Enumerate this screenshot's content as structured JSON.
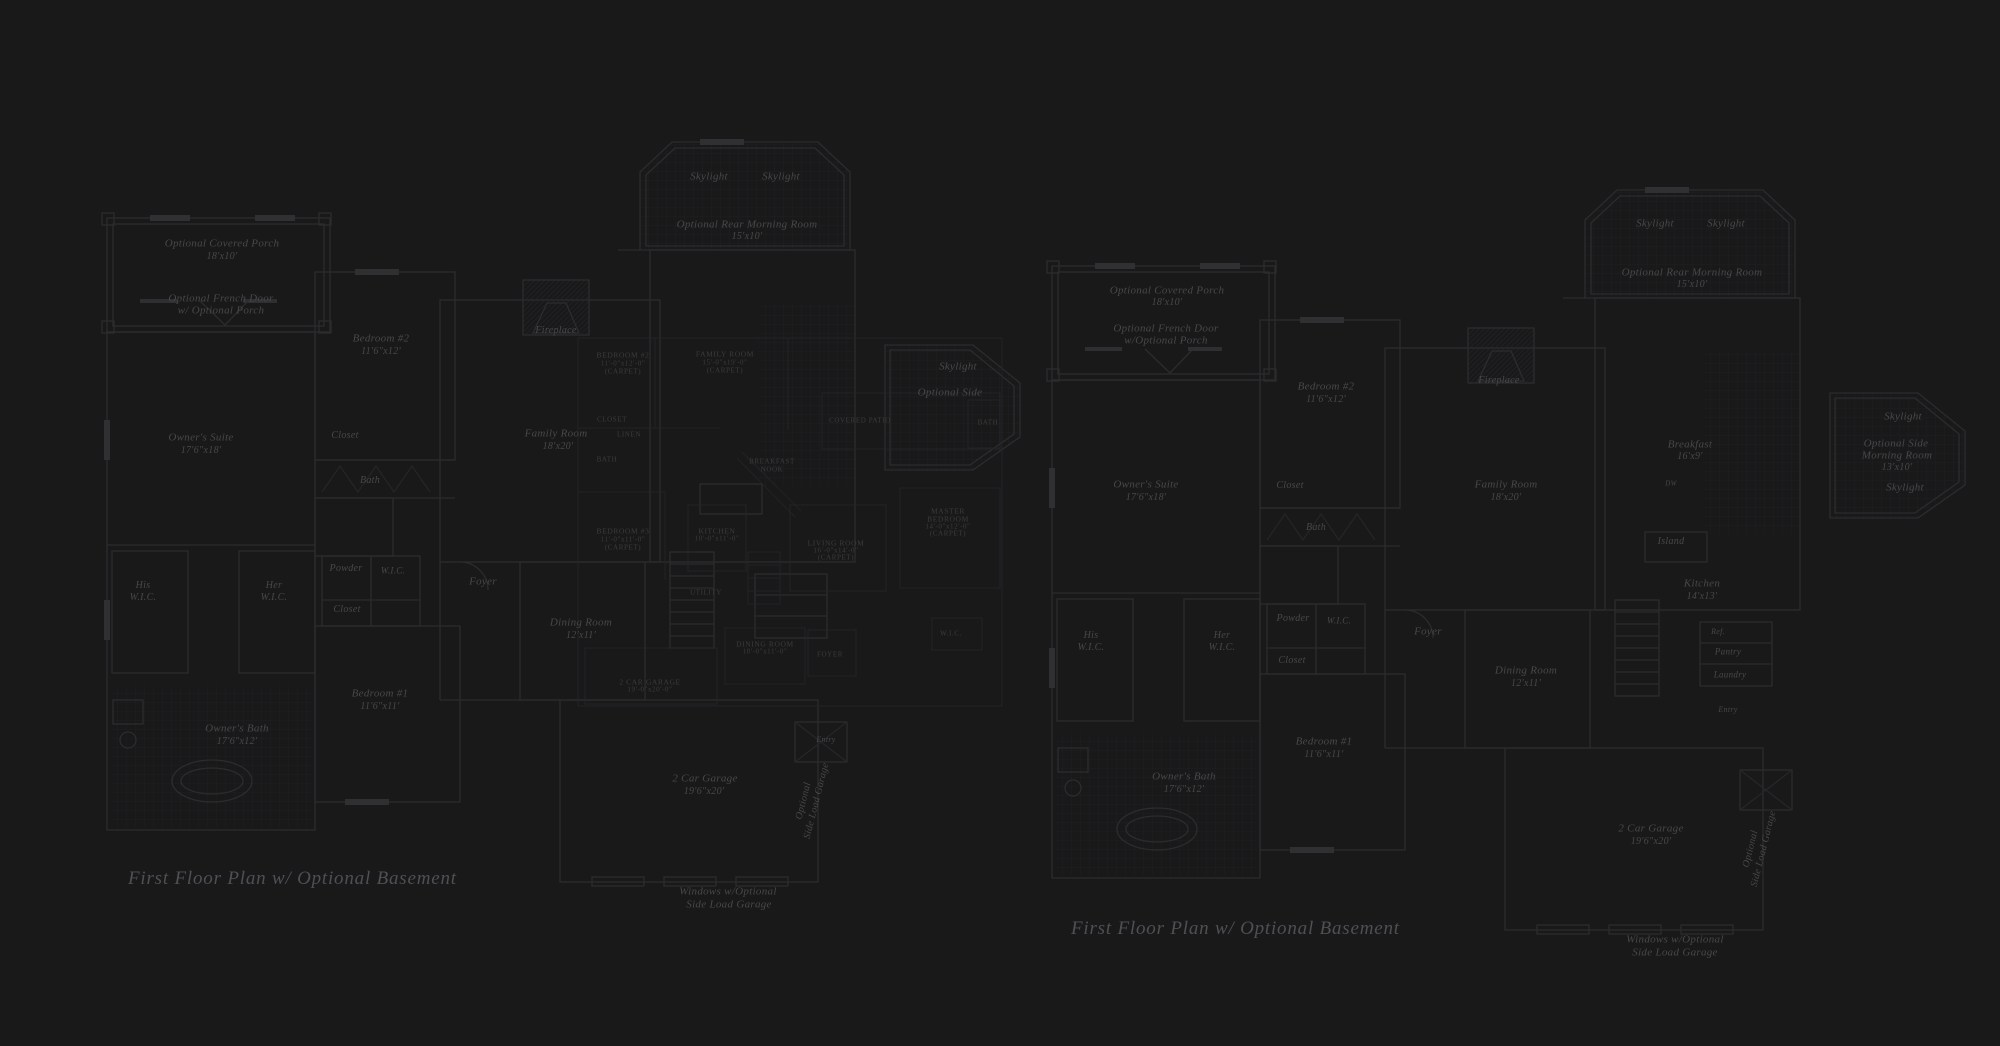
{
  "canvas": {
    "background": "#19191a"
  },
  "colors": {
    "wall_line": "#2c2c2e",
    "wall_line_faint": "#242426",
    "tile_line": "#212123",
    "window_fill": "#303032",
    "label_main": "#48484a",
    "label_inset": "#3c3c3e",
    "caption": "#4f4f55"
  },
  "captions": [
    {
      "text": "First Floor Plan  w/ Optional Basement",
      "x": 128,
      "y": 868
    },
    {
      "text": "First Floor Plan  w/ Optional Basement",
      "x": 1071,
      "y": 918
    }
  ],
  "plans": {
    "left": {
      "title": "first-floor-plan-left",
      "default_size": 11,
      "labels": [
        {
          "t": "Optional Covered Porch",
          "x": 222,
          "y": 244
        },
        {
          "t": "18'x10'",
          "x": 222,
          "y": 257,
          "s": 10
        },
        {
          "t": "Optional French Door",
          "x": 221,
          "y": 299
        },
        {
          "t": "w/ Optional Porch",
          "x": 221,
          "y": 311
        },
        {
          "t": "Bedroom #2",
          "x": 381,
          "y": 339
        },
        {
          "t": "11'6\"x12'",
          "x": 381,
          "y": 352,
          "s": 10
        },
        {
          "t": "Owner's Suite",
          "x": 201,
          "y": 438
        },
        {
          "t": "17'6\"x18'",
          "x": 201,
          "y": 451,
          "s": 10
        },
        {
          "t": "Closet",
          "x": 345,
          "y": 436,
          "s": 10
        },
        {
          "t": "Bath",
          "x": 370,
          "y": 481,
          "s": 10
        },
        {
          "t": "His",
          "x": 143,
          "y": 586,
          "s": 10
        },
        {
          "t": "W.I.C.",
          "x": 143,
          "y": 598,
          "s": 10
        },
        {
          "t": "Her",
          "x": 274,
          "y": 586,
          "s": 10
        },
        {
          "t": "W.I.C.",
          "x": 274,
          "y": 598,
          "s": 10
        },
        {
          "t": "Powder",
          "x": 346,
          "y": 569,
          "s": 10
        },
        {
          "t": "W.I.C.",
          "x": 393,
          "y": 571,
          "s": 9
        },
        {
          "t": "Closet",
          "x": 347,
          "y": 610,
          "s": 10
        },
        {
          "t": "Bedroom #1",
          "x": 380,
          "y": 694
        },
        {
          "t": "11'6\"x11'",
          "x": 380,
          "y": 707,
          "s": 10
        },
        {
          "t": "Owner's Bath",
          "x": 237,
          "y": 729
        },
        {
          "t": "17'6\"x12'",
          "x": 237,
          "y": 742,
          "s": 10
        },
        {
          "t": "Foyer",
          "x": 483,
          "y": 582
        },
        {
          "t": "Dining Room",
          "x": 581,
          "y": 623
        },
        {
          "t": "12'x11'",
          "x": 581,
          "y": 636,
          "s": 10
        },
        {
          "t": "Family Room",
          "x": 556,
          "y": 434
        },
        {
          "t": "18'x20'",
          "x": 558,
          "y": 447,
          "s": 10
        },
        {
          "t": "Fireplace",
          "x": 556,
          "y": 331,
          "s": 10
        },
        {
          "t": "Skylight",
          "x": 709,
          "y": 177
        },
        {
          "t": "Skylight",
          "x": 781,
          "y": 177
        },
        {
          "t": "Optional Rear Morning Room",
          "x": 747,
          "y": 225
        },
        {
          "t": "15'x10'",
          "x": 747,
          "y": 237,
          "s": 10
        },
        {
          "t": "2 Car Garage",
          "x": 705,
          "y": 779
        },
        {
          "t": "19'6\"x20'",
          "x": 704,
          "y": 792,
          "s": 10
        },
        {
          "t": "Optional",
          "x": 804,
          "y": 801,
          "s": 10,
          "r": -76
        },
        {
          "t": "Side Load Garage",
          "x": 817,
          "y": 801,
          "s": 10,
          "r": -76
        },
        {
          "t": "Entry",
          "x": 826,
          "y": 740,
          "s": 8
        },
        {
          "t": "Windows w/Optional",
          "x": 728,
          "y": 892
        },
        {
          "t": "Side Load Garage",
          "x": 729,
          "y": 905
        },
        {
          "t": "Skylight",
          "x": 958,
          "y": 367
        },
        {
          "t": "Optional Side",
          "x": 950,
          "y": 393
        }
      ]
    },
    "right": {
      "title": "first-floor-plan-right",
      "default_size": 11,
      "labels": [
        {
          "t": "Optional Covered Porch",
          "x": 1167,
          "y": 291
        },
        {
          "t": "18'x10'",
          "x": 1167,
          "y": 303,
          "s": 10
        },
        {
          "t": "Optional French Door",
          "x": 1166,
          "y": 329
        },
        {
          "t": "w/Optional Porch",
          "x": 1166,
          "y": 341
        },
        {
          "t": "Bedroom #2",
          "x": 1326,
          "y": 387
        },
        {
          "t": "11'6\"x12'",
          "x": 1326,
          "y": 400,
          "s": 10
        },
        {
          "t": "Owner's Suite",
          "x": 1146,
          "y": 485
        },
        {
          "t": "17'6\"x18'",
          "x": 1146,
          "y": 498,
          "s": 10
        },
        {
          "t": "Closet",
          "x": 1290,
          "y": 486,
          "s": 10
        },
        {
          "t": "Bath",
          "x": 1316,
          "y": 528,
          "s": 10
        },
        {
          "t": "His",
          "x": 1091,
          "y": 636,
          "s": 10
        },
        {
          "t": "W.I.C.",
          "x": 1091,
          "y": 648,
          "s": 10
        },
        {
          "t": "Her",
          "x": 1222,
          "y": 636,
          "s": 10
        },
        {
          "t": "W.I.C.",
          "x": 1222,
          "y": 648,
          "s": 10
        },
        {
          "t": "Powder",
          "x": 1293,
          "y": 619,
          "s": 10
        },
        {
          "t": "W.I.C.",
          "x": 1339,
          "y": 621,
          "s": 9
        },
        {
          "t": "Closet",
          "x": 1292,
          "y": 661,
          "s": 10
        },
        {
          "t": "Bedroom #1",
          "x": 1324,
          "y": 742
        },
        {
          "t": "11'6\"x11'",
          "x": 1324,
          "y": 755,
          "s": 10
        },
        {
          "t": "Owner's Bath",
          "x": 1184,
          "y": 777
        },
        {
          "t": "17'6\"x12'",
          "x": 1184,
          "y": 790,
          "s": 10
        },
        {
          "t": "Foyer",
          "x": 1428,
          "y": 632
        },
        {
          "t": "Dining Room",
          "x": 1526,
          "y": 671
        },
        {
          "t": "12'x11'",
          "x": 1526,
          "y": 684,
          "s": 10
        },
        {
          "t": "Family Room",
          "x": 1506,
          "y": 485
        },
        {
          "t": "18'x20'",
          "x": 1506,
          "y": 498,
          "s": 10
        },
        {
          "t": "Fireplace",
          "x": 1499,
          "y": 381,
          "s": 10
        },
        {
          "t": "Skylight",
          "x": 1655,
          "y": 224
        },
        {
          "t": "Skylight",
          "x": 1726,
          "y": 224
        },
        {
          "t": "Optional Rear Morning Room",
          "x": 1692,
          "y": 273
        },
        {
          "t": "15'x10'",
          "x": 1692,
          "y": 285,
          "s": 10
        },
        {
          "t": "Breakfast",
          "x": 1690,
          "y": 445
        },
        {
          "t": "16'x9'",
          "x": 1690,
          "y": 457,
          "s": 10
        },
        {
          "t": "DW",
          "x": 1671,
          "y": 484,
          "s": 7
        },
        {
          "t": "Island",
          "x": 1671,
          "y": 542,
          "s": 10
        },
        {
          "t": "Kitchen",
          "x": 1702,
          "y": 584
        },
        {
          "t": "14'x13'",
          "x": 1702,
          "y": 597,
          "s": 10
        },
        {
          "t": "Ref.",
          "x": 1718,
          "y": 632,
          "s": 8
        },
        {
          "t": "Pantry",
          "x": 1728,
          "y": 652,
          "s": 9
        },
        {
          "t": "Laundry",
          "x": 1730,
          "y": 675,
          "s": 9
        },
        {
          "t": "Entry",
          "x": 1728,
          "y": 710,
          "s": 8
        },
        {
          "t": "2 Car Garage",
          "x": 1651,
          "y": 829
        },
        {
          "t": "19'6\"x20'",
          "x": 1651,
          "y": 842,
          "s": 10
        },
        {
          "t": "Optional",
          "x": 1751,
          "y": 849,
          "s": 10,
          "r": -76
        },
        {
          "t": "Side Load Garage",
          "x": 1764,
          "y": 849,
          "s": 10,
          "r": -76
        },
        {
          "t": "Windows w/Optional",
          "x": 1675,
          "y": 940
        },
        {
          "t": "Side Load Garage",
          "x": 1675,
          "y": 953
        },
        {
          "t": "Skylight",
          "x": 1903,
          "y": 417
        },
        {
          "t": "Optional Side",
          "x": 1896,
          "y": 444
        },
        {
          "t": "Morning Room",
          "x": 1897,
          "y": 456
        },
        {
          "t": "13'x10'",
          "x": 1897,
          "y": 468,
          "s": 10
        },
        {
          "t": "Skylight",
          "x": 1905,
          "y": 488
        }
      ]
    },
    "inset": {
      "title": "optional-basement-inset-plan",
      "default_size": 7.5,
      "labels": [
        {
          "t": "BEDROOM #2",
          "x": 623,
          "y": 355
        },
        {
          "t": "11'-0\"x12'-0\"",
          "x": 623,
          "y": 364,
          "s": 7
        },
        {
          "t": "(CARPET)",
          "x": 623,
          "y": 372,
          "s": 7
        },
        {
          "t": "FAMILY ROOM",
          "x": 725,
          "y": 354
        },
        {
          "t": "15'-0\"x19'-0\"",
          "x": 725,
          "y": 363,
          "s": 7
        },
        {
          "t": "(CARPET)",
          "x": 725,
          "y": 371,
          "s": 7
        },
        {
          "t": "CLOSET",
          "x": 612,
          "y": 420,
          "s": 7
        },
        {
          "t": "LINEN",
          "x": 629,
          "y": 435,
          "s": 7
        },
        {
          "t": "BATH",
          "x": 607,
          "y": 460,
          "s": 7
        },
        {
          "t": "BREAKFAST",
          "x": 772,
          "y": 462,
          "s": 7
        },
        {
          "t": "NOOK",
          "x": 772,
          "y": 470,
          "s": 7
        },
        {
          "t": "COVERED PATIO",
          "x": 860,
          "y": 421,
          "s": 7
        },
        {
          "t": "BATH",
          "x": 988,
          "y": 423,
          "s": 7
        },
        {
          "t": "BEDROOM #3",
          "x": 623,
          "y": 531
        },
        {
          "t": "11'-0\"x11'-0\"",
          "x": 623,
          "y": 540,
          "s": 7
        },
        {
          "t": "(CARPET)",
          "x": 623,
          "y": 548,
          "s": 7
        },
        {
          "t": "KITCHEN",
          "x": 717,
          "y": 531
        },
        {
          "t": "10'-0\"x11'-0\"",
          "x": 717,
          "y": 539,
          "s": 7
        },
        {
          "t": "LIVING ROOM",
          "x": 836,
          "y": 543
        },
        {
          "t": "16'-0\"x14'-0\"",
          "x": 836,
          "y": 551,
          "s": 7
        },
        {
          "t": "(CARPET)",
          "x": 836,
          "y": 558,
          "s": 7
        },
        {
          "t": "MASTER",
          "x": 948,
          "y": 511
        },
        {
          "t": "BEDROOM",
          "x": 948,
          "y": 519
        },
        {
          "t": "14'-0\"x12'-0\"",
          "x": 948,
          "y": 527,
          "s": 7
        },
        {
          "t": "(CARPET)",
          "x": 948,
          "y": 534,
          "s": 7
        },
        {
          "t": "UTILITY",
          "x": 706,
          "y": 593,
          "s": 7
        },
        {
          "t": "W.I.C.",
          "x": 951,
          "y": 634,
          "s": 7
        },
        {
          "t": "DINING ROOM",
          "x": 765,
          "y": 644
        },
        {
          "t": "10'-0\"x11'-0\"",
          "x": 765,
          "y": 652,
          "s": 7
        },
        {
          "t": "FOYER",
          "x": 830,
          "y": 655,
          "s": 7
        },
        {
          "t": "2 CAR GARAGE",
          "x": 650,
          "y": 682
        },
        {
          "t": "19'-0\"x20'-0\"",
          "x": 650,
          "y": 690,
          "s": 7
        }
      ]
    }
  }
}
